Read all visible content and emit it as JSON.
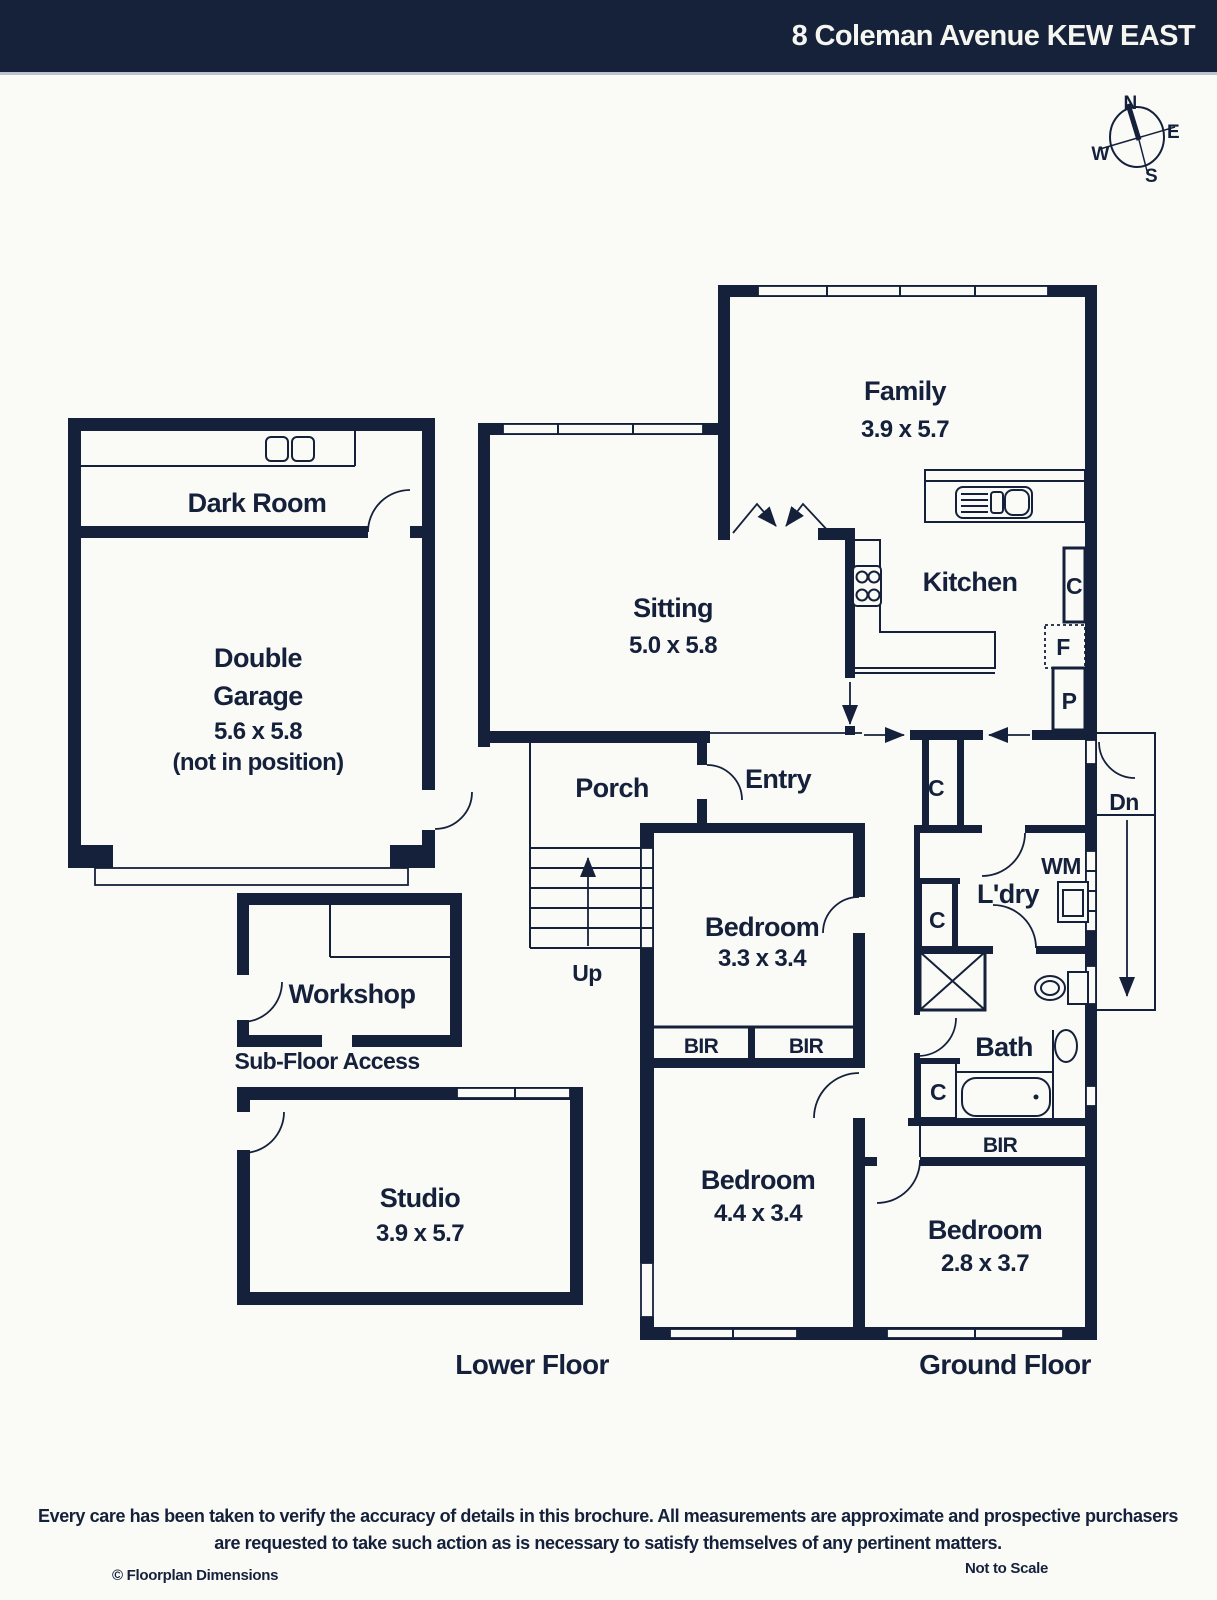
{
  "page": {
    "background": "#fafaf7",
    "ink": "#15213b",
    "header_bg": "#16213a"
  },
  "header": {
    "title": "8 Coleman Avenue KEW EAST"
  },
  "compass": {
    "north": "N",
    "east": "E",
    "south": "S",
    "west": "W"
  },
  "floors": {
    "lower": "Lower Floor",
    "ground": "Ground Floor"
  },
  "rooms": {
    "family": {
      "name": "Family",
      "dims": "3.9 x 5.7"
    },
    "kitchen": {
      "name": "Kitchen"
    },
    "sitting": {
      "name": "Sitting",
      "dims": "5.0 x 5.8"
    },
    "dark_room": {
      "name": "Dark Room"
    },
    "garage": {
      "line1": "Double",
      "line2": "Garage",
      "dims": "5.6 x 5.8",
      "note": "(not in position)"
    },
    "porch": {
      "name": "Porch"
    },
    "entry": {
      "name": "Entry"
    },
    "laundry": {
      "name": "L'dry"
    },
    "bath": {
      "name": "Bath"
    },
    "bedroom_1": {
      "name": "Bedroom",
      "dims": "3.3 x 3.4"
    },
    "bedroom_2": {
      "name": "Bedroom",
      "dims": "4.4 x 3.4"
    },
    "bedroom_3": {
      "name": "Bedroom",
      "dims": "2.8 x 3.7"
    },
    "workshop": {
      "name": "Workshop"
    },
    "studio": {
      "name": "Studio",
      "dims": "3.9 x 5.7"
    },
    "sub_floor": {
      "name": "Sub-Floor Access"
    }
  },
  "markers": {
    "up": "Up",
    "dn": "Dn",
    "wm": "WM",
    "cupboard": "C",
    "fridge": "F",
    "pantry": "P",
    "bir": "BIR"
  },
  "footer": {
    "disclaimer_1": "Every care has been taken to verify the accuracy of details in this brochure. All measurements are approximate and prospective purchasers",
    "disclaimer_2": "are requested to take such action as is necessary to satisfy themselves of any pertinent matters.",
    "credit": "© Floorplan Dimensions",
    "scale": "Not to Scale"
  }
}
